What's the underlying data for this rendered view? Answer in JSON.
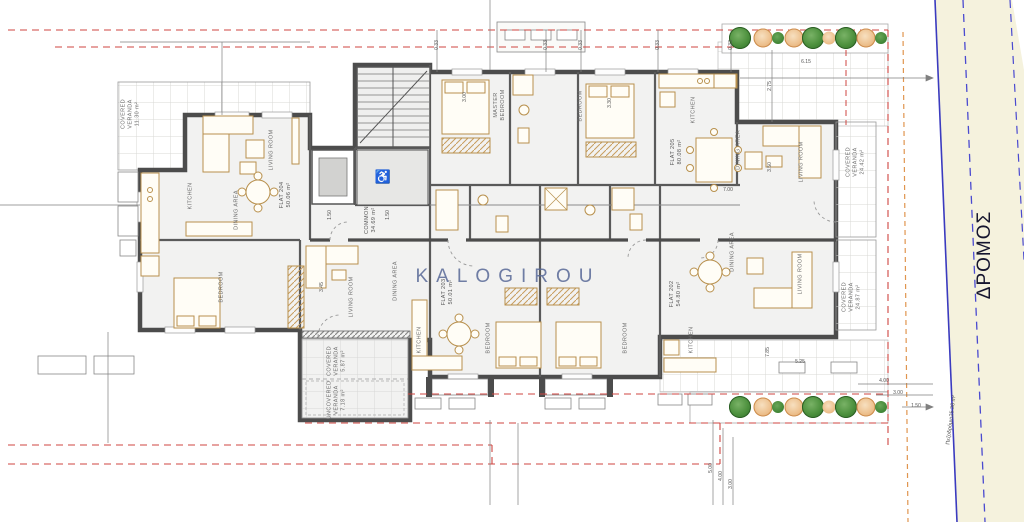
{
  "watermark": "KALOGIROU",
  "road": {
    "name": "ΔΡΟΜΟΣ",
    "sidewalk_label": "Πεζοδρόμιο",
    "sidewalk_area": "25.38 m²"
  },
  "common": {
    "label": "COMMON",
    "area": "34.69 m²"
  },
  "flats": {
    "flat204": {
      "label": "FLAT 204",
      "area": "50.06 m²",
      "veranda_label": "COVERED VERANDA",
      "veranda_area": "11.30 m²",
      "rooms": {
        "living": "LIVING ROOM",
        "kitchen": "KITCHEN",
        "dining": "DINING AREA",
        "bedroom": "BEDROOM"
      }
    },
    "flat205": {
      "label": "FLAT 205",
      "area": "80.08 m²",
      "veranda_label": "COVERED VERANDA",
      "veranda_area": "24.42 m²",
      "rooms": {
        "master": "MASTER BEDROOM",
        "bedroom": "BEDROOM",
        "kitchen": "KITCHEN",
        "dining": "DINING AREA",
        "living": "LIVING ROOM"
      }
    },
    "flat203": {
      "label": "FLAT 203",
      "area": "50.01 m²",
      "covered_label": "COVERED VERANDA",
      "covered_area": "5.87 m²",
      "uncovered_label": "UNCOVERED VERANDA",
      "uncovered_area": "7.18 m²",
      "rooms": {
        "living": "LIVING ROOM",
        "dining": "DINING AREA",
        "kitchen": "KITCHEN",
        "bedroom": "BEDROOM"
      }
    },
    "flat202": {
      "label": "FLAT 202",
      "area": "54.80 m²",
      "veranda_label": "COVERED VERANDA",
      "veranda_area": "24.87 m²",
      "rooms": {
        "dining": "DINING AREA",
        "living": "LIVING ROOM",
        "kitchen": "KITCHEN",
        "bedroom": "BEDROOM"
      }
    }
  },
  "dimensions": [
    "0.33",
    "0.33",
    "0.33",
    "0.33",
    "0.33",
    "2.75",
    "6.15",
    "3.00",
    "3.30",
    "3.45",
    "3.50",
    "7.00",
    "1.50",
    "1.50",
    "7.85",
    "5.25",
    "4.00",
    "3.00",
    "1.50",
    "5.00",
    "4.00",
    "3.00"
  ],
  "icons": {
    "wheelchair": "♿"
  },
  "colors": {
    "wall": "#4c4c4c",
    "furniture": "#b8904d",
    "boundary_red": "#cf4540",
    "boundary_orange": "#e0954f",
    "road_line": "#3b3bbf",
    "road_fill": "#f5f2dd",
    "tree_green": "#3a7d33",
    "tree_orange": "#ecbe8a",
    "watermark": "#586896"
  }
}
